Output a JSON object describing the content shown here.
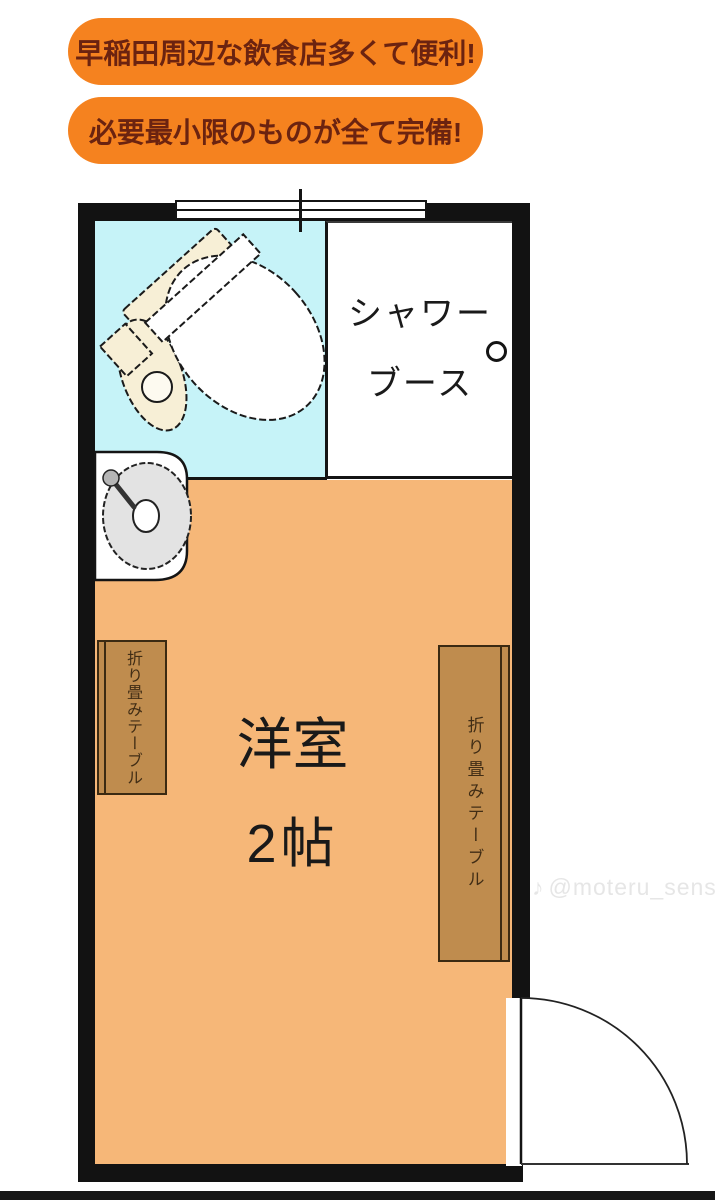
{
  "callouts": [
    {
      "text": "早稲田周辺な飲食店多くて便利!"
    },
    {
      "text": "必要最小限のものが全て完備!"
    }
  ],
  "floorplan": {
    "shower_booth": {
      "label_line1": "シャワー",
      "label_line2": "ブース"
    },
    "room": {
      "name": "洋室",
      "size": "2帖"
    },
    "tables": {
      "left_label": "折り畳みテーブル",
      "right_label": "折り畳みテーブル"
    },
    "fixtures": [
      "toilet",
      "sink",
      "shower-drain",
      "window",
      "door-swing"
    ]
  },
  "watermark": {
    "note_glyph": "♪",
    "handle": "@moteru_sensei"
  },
  "colors": {
    "bubble_bg": "#f5821f",
    "bubble_text": "#6b2310",
    "floor_orange": "#f6b778",
    "wet_area_cyan": "#c6f3f8",
    "table_brown": "#bf8c4e",
    "table_border": "#3b2a12",
    "wall_black": "#121212",
    "toilet_cream": "#f7efd6",
    "basin_gray": "#e3e3e3",
    "watermark_gray": "#e6e6e6"
  }
}
